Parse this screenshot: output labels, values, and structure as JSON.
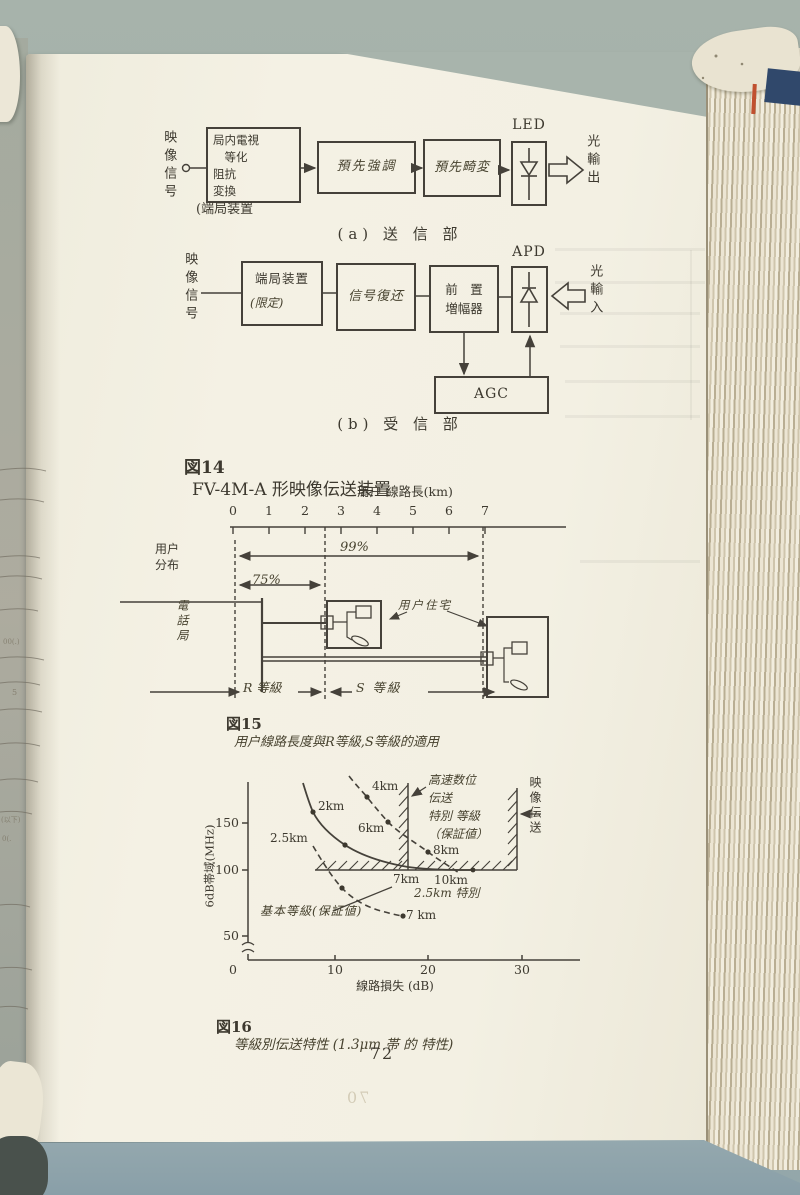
{
  "page": {
    "number": "72",
    "bleed_number": "70",
    "edge_fragments": [
      "00(.)",
      "5",
      "(以下)",
      "0(."
    ]
  },
  "fig14": {
    "caption_no": "図14",
    "caption_text": "FV-4M-A 形映像伝送装置",
    "tx": {
      "input_label": "映像信号",
      "box1": "局内電視\n　等化\n阻抗\n変換",
      "box1_sub": "(端局装置",
      "box2": "預先強調",
      "box3": "預先畸変",
      "led": "LED",
      "output_label": "光輸出",
      "caption": "(a) 送 信 部"
    },
    "rx": {
      "input_label": "映像信号",
      "box1_line1": "端局装置",
      "box1_line2": "(限定)",
      "box2": "信号復还",
      "box3": "前　置\n増幅器",
      "apd": "APD",
      "agc": "AGC",
      "input_light": "光輸入",
      "caption": "(b) 受 信 部"
    }
  },
  "fig15": {
    "axis_title": "用户 線路長(km)",
    "ticks": [
      "0",
      "1",
      "2",
      "3",
      "4",
      "5",
      "6",
      "7"
    ],
    "dist_label": "用户\n分布",
    "pct99": "99%",
    "pct75": "75%",
    "office": "電話局",
    "house_label": "用户住宅",
    "r_grade": "R 等級",
    "s_grade": "S 等級",
    "r_grade_range_km": [
      0,
      2.5
    ],
    "s_grade_range_km": [
      2.5,
      7
    ],
    "caption_no": "図15",
    "caption_text": "用户線路長度與R等級,S等級的適用"
  },
  "fig16": {
    "y_label": "6dB帯域(MHz)",
    "y_ticks": [
      "150",
      "100",
      "50"
    ],
    "x_ticks": [
      "0",
      "10",
      "20",
      "30"
    ],
    "x_label": "線路損失 (dB)",
    "p_2km": "2km",
    "p_4km": "4km",
    "p_25km": "2.5km",
    "p_6km": "6km",
    "p_8km": "8km",
    "p_7km": "7km",
    "p_10km": "10km",
    "p_25s": "2.5km 特別",
    "p_7kmb": "7 km",
    "ann_highspeed": "高速数位\n伝送\n特別 等級\n（保証値）",
    "ann_basic": "基本等級(保証値)",
    "right_label": "映像伝送",
    "caption_no": "図16",
    "caption_text": "等級別伝送特性 (1.3μm 帯 的 特性)"
  },
  "chart_data": {
    "type": "line",
    "figure": "図16",
    "title": "等級別伝送特性 (1.3μm 帯 的 特性)",
    "xlabel": "線路損失 (dB)",
    "ylabel": "6dB帯域(MHz)",
    "xlim": [
      0,
      33
    ],
    "ylim": [
      0,
      200
    ],
    "y_axis_break": true,
    "x_ticks": [
      0,
      10,
      20,
      30
    ],
    "y_ticks": [
      50,
      100,
      150
    ],
    "series": [
      {
        "name": "特別等級曲線 (実線)",
        "style": "solid",
        "points": [
          [
            6.3,
            192
          ],
          [
            7.5,
            160
          ],
          [
            11,
            127
          ],
          [
            14.5,
            111
          ],
          [
            18,
            104
          ],
          [
            22,
            101
          ],
          [
            25.3,
            100
          ]
        ],
        "labeled_points": {
          "2km": [
            7.5,
            160
          ],
          "2.5km": [
            11,
            127
          ],
          "7km": [
            17.5,
            100
          ]
        }
      },
      {
        "name": "高速数位伝送 特別等級（保証値）",
        "style": "dashed",
        "points": [
          [
            11.3,
            200
          ],
          [
            13.3,
            178
          ],
          [
            15.7,
            151
          ],
          [
            20.1,
            119
          ],
          [
            23.6,
            98
          ]
        ],
        "labeled_points": {
          "4km": [
            13.3,
            178
          ],
          "6km": [
            15.7,
            151
          ],
          "8km": [
            20.1,
            119
          ],
          "10km": [
            22.4,
            100
          ]
        }
      },
      {
        "name": "基本等級（保証値）",
        "style": "dashed",
        "points": [
          [
            7.3,
            126
          ],
          [
            10.5,
            81
          ],
          [
            17.3,
            51
          ]
        ],
        "labeled_points": {
          "7 km": [
            17.3,
            51
          ]
        }
      }
    ],
    "annotations": [
      "高速数位伝送 特別 等級（保証値）",
      "基本等級(保証値)",
      "2.5km 特別",
      "映像伝送"
    ],
    "boundaries": {
      "video_band_floor_MHz": 100,
      "special_grade_loss_limit_dB": 17.9,
      "video_transmission_loss_limit_dB": 30.1
    }
  }
}
